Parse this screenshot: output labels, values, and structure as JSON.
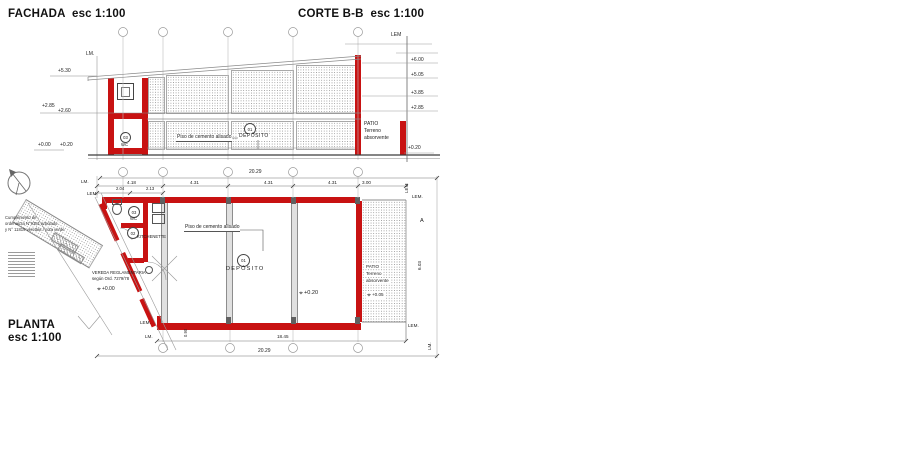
{
  "titles": {
    "fachada": "FACHADA  esc 1:100",
    "corte": "CORTE B-B  esc 1:100",
    "planta_1": "PLANTA",
    "planta_2": "esc 1:100"
  },
  "colors": {
    "wall_red": "#c81212",
    "line_gray": "#8a8a8a"
  },
  "fachada": {
    "lm": "LM.",
    "levels": [
      {
        "v": "+5.30"
      },
      {
        "v": "+2.85"
      },
      {
        "v": "+2.60"
      },
      {
        "v": "+0.00"
      },
      {
        "v": "+0.20"
      }
    ],
    "room03_num": "03",
    "room03_name": "WC",
    "floor": "Piso de cemento alisado",
    "room01_num": "01",
    "room01_name": "DEPÓSITO"
  },
  "corte": {
    "lem": "LEM",
    "levels": [
      {
        "v": "+6.00"
      },
      {
        "v": "+5.05"
      },
      {
        "v": "+3.85"
      },
      {
        "v": "+2.85"
      }
    ],
    "patio": [
      "PATIO",
      "Terreno",
      "absorvente"
    ],
    "patio_level": "+0.20"
  },
  "planta": {
    "dim_total_top": "20.29",
    "dims_top": [
      {
        "v": "4.18"
      },
      {
        "v": "4.31"
      },
      {
        "v": "4.31"
      },
      {
        "v": "4.31"
      },
      {
        "v": "3.00"
      }
    ],
    "dims_sub": [
      {
        "v": "2.04"
      },
      {
        "v": "2.13"
      }
    ],
    "lm_top": "LM.",
    "lem_top": "LEM.",
    "lem_right_v": "LEM",
    "lem_right": "LEM.",
    "marker_a": "A",
    "dim_right": "6.03",
    "door_dim": "0.90",
    "room03_num": "03",
    "room03_name": "WC",
    "room02_num": "02",
    "room02_name": "KITCHENETTE",
    "room01_num": "01",
    "room01_name": "DEPÓSITO",
    "floor": "Piso de cemento alisado",
    "level_main": "+0.20",
    "patio": [
      "PATIO",
      "Terreno",
      "absorvente"
    ],
    "patio_level": "+0.05",
    "vereda_1": "VEREDA REGLAMENTARIA",
    "vereda_2": "según Ord. 7279/78",
    "vereda_level": "+0.00",
    "lem_bl": "LEM.",
    "lm_bl": "LM.",
    "lem_br": "LEM.",
    "lm_br": "LM.",
    "dim_bottom_inner": "18.45",
    "dim_bottom_total": "20.29",
    "notes": [
      {
        "t": "Cumplimiento de"
      },
      {
        "t": "ordenanza N°9381 arbolado"
      },
      {
        "t": "y N° 11819 veredas / cota verde"
      }
    ]
  }
}
